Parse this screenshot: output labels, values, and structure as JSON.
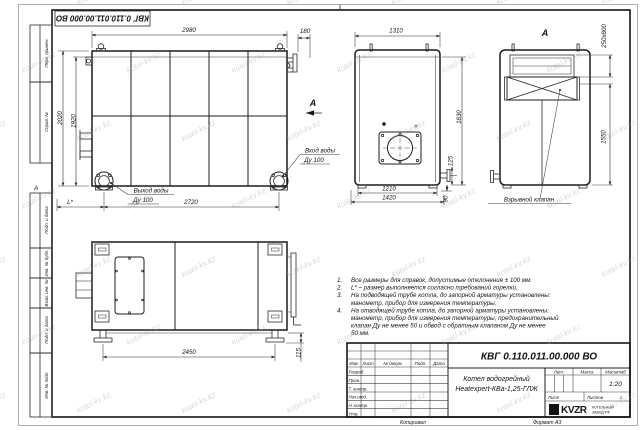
{
  "watermark": {
    "text": "kotel-kv.kz"
  },
  "stamp_top": "КВГ 0.110.011.00.000 ВО",
  "frame": {
    "zone_a": "А",
    "perv_primen": "Перв. примен.",
    "sprav_no": "Справ. №",
    "podp_data_1": "Подп. и дата",
    "inv_dubl": "Инв. № дубл.",
    "vzam_inv": "Взам. инв. №",
    "podp_data_2": "Подп. и дата",
    "inv_podl": "Инв. № подл."
  },
  "view_side": {
    "dim_2980": "2980",
    "dim_180": "180",
    "dim_2020": "2020",
    "dim_1920": "1920",
    "dim_2720": "2720",
    "dim_l": "L*",
    "view_arrow_label": "А",
    "inlet_line1": "Вход воды",
    "inlet_line2": "Ду 100",
    "outlet_line1": "Выход воды",
    "outlet_line2": "Ду 100"
  },
  "view_front": {
    "dim_1310": "1310",
    "dim_1830": "1830",
    "dim_125": "125",
    "dim_90": "90",
    "dim_1210": "1210",
    "dim_1420": "1420"
  },
  "view_rear": {
    "title": "А",
    "dim_250x800": "250x800",
    "dim_1550": "1550",
    "valve_label": "Взрывной клапан"
  },
  "view_top": {
    "dim_2450": "2450",
    "dim_115": "115"
  },
  "notes": {
    "lines": [
      {
        "n": "1.",
        "t": "Все размеры для справок, допустимые отклонения ± 100 мм."
      },
      {
        "n": "2.",
        "t": "L* – размер выполняется согласно требований горелки."
      },
      {
        "n": "3.",
        "t": "На подводящей трубе котла, до запорной арматуры установлены:"
      },
      {
        "n": "",
        "t": "манометр, прибор для измерения температуры."
      },
      {
        "n": "4.",
        "t": "На отводящей трубе котла, до запорной арматуры установлены:"
      },
      {
        "n": "",
        "t": "манометр, прибор для измерения температуры, предохранительный"
      },
      {
        "n": "",
        "t": "клапан Ду не менее 50 и обвод с обратным клапаном Ду не менее"
      },
      {
        "n": "",
        "t": "50 мм."
      }
    ]
  },
  "title_block": {
    "doc_number": "КВГ 0.110.011.00.000 ВО",
    "cols": {
      "izm": "Изм.",
      "list": "Лист",
      "doc": "№ докум.",
      "podp": "Подп.",
      "data": "Дата"
    },
    "rows": {
      "razrab": "Разраб.",
      "prov": "Пров.",
      "tkontr": "Т. контр.",
      "nachotd": "Нач.отд.",
      "nkontr": "Н. контр.",
      "utv": "Утв."
    },
    "product_line1": "Котел водогрейный",
    "product_line2": "Heatexpert-КВа-1,25-ГЛЖ",
    "lit": "Лит.",
    "massa": "Масса",
    "masshtab": "Масштаб",
    "scale": "1:20",
    "list_label": "Лист",
    "listov_label": "Листов",
    "listov_value": "1",
    "logo": "KVZR",
    "org_line1": "КОТЕЛЬНЫЙ",
    "org_line2": "ЗАВОД.РФ",
    "copied": "Копировал",
    "format": "Формат А3"
  }
}
